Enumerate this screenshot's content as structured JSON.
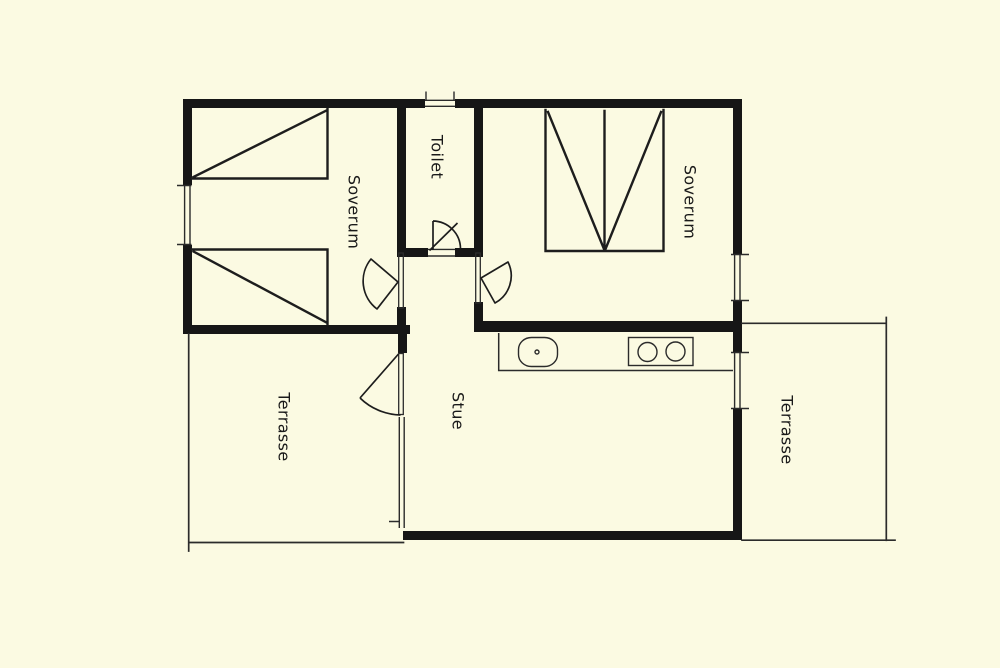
{
  "palette": {
    "background": "#FBFAE2",
    "wall": "#161616",
    "line": "#2B2B2B",
    "text": "#191919"
  },
  "plan": {
    "type": "floor-plan",
    "rooms": [
      {
        "id": "soverum-left",
        "label": "Soverum",
        "features": [
          "single-bed",
          "single-bed",
          "window-west",
          "door-to-hall"
        ]
      },
      {
        "id": "toilet",
        "label": "Toilet",
        "features": [
          "window-north",
          "door-to-hall"
        ]
      },
      {
        "id": "soverum-right",
        "label": "Soverum",
        "features": [
          "double-bed",
          "window-east",
          "door-to-hall"
        ]
      },
      {
        "id": "stue",
        "label": "Stue",
        "features": [
          "kitchen-counter",
          "sink",
          "stove",
          "window-east",
          "window-wall-west",
          "door-to-terrasse"
        ]
      },
      {
        "id": "terrasse-left",
        "label": "Terrasse",
        "features": []
      },
      {
        "id": "terrasse-right",
        "label": "Terrasse",
        "features": []
      }
    ]
  }
}
